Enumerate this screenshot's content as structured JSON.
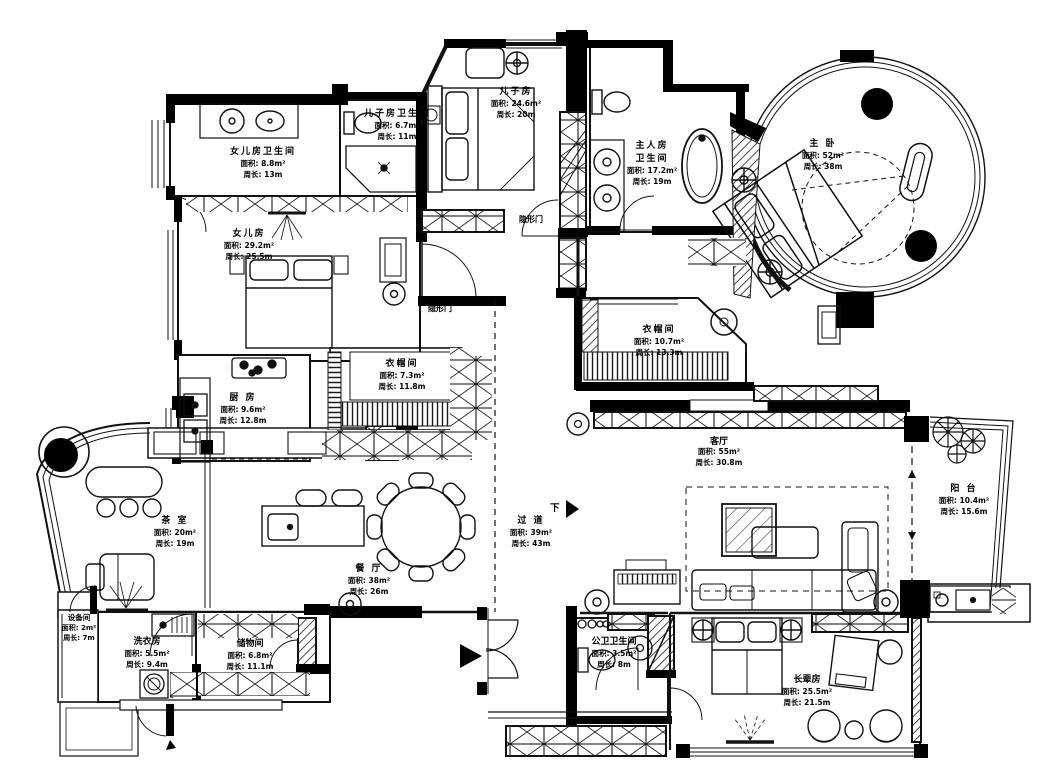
{
  "plan_title": "apartment-floor-plan",
  "colors": {
    "wall": "#000000",
    "line": "#1a1a1a",
    "background": "#ffffff"
  },
  "rooms": {
    "daughter_bath": {
      "name": "女儿房卫生间",
      "area": "面积: 8.8m²",
      "perimeter": "周长: 13m"
    },
    "son_bath": {
      "name": "儿子房卫生间",
      "area": "面积: 6.7m²",
      "perimeter": "周长: 11m"
    },
    "son_room": {
      "name": "儿子房",
      "area": "面积: 24.6m²",
      "perimeter": "周长: 20m"
    },
    "master_bath": {
      "name": "主人房",
      "name2": "卫生间",
      "area": "面积: 17.2m²",
      "perimeter": "周长: 19m"
    },
    "master_bedroom": {
      "name": "主 卧",
      "area": "面积: 52m²",
      "perimeter": "周长: 38m"
    },
    "daughter_room": {
      "name": "女儿房",
      "area": "面积: 29.2m²",
      "perimeter": "周长: 25.5m"
    },
    "closet_a": {
      "name": "衣帽间",
      "area": "面积: 7.3m²",
      "perimeter": "周长: 11.8m"
    },
    "closet_b": {
      "name": "衣帽间",
      "area": "面积: 10.7m²",
      "perimeter": "周长: 13.3m"
    },
    "kitchen": {
      "name": "厨 房",
      "area": "面积: 9.6m²",
      "perimeter": "周长: 12.8m"
    },
    "tea_room": {
      "name": "茶 室",
      "area": "面积: 20m²",
      "perimeter": "周长: 19m"
    },
    "dining": {
      "name": "餐 厅",
      "area": "面积: 38m²",
      "perimeter": "周长: 26m"
    },
    "corridor": {
      "name": "过 道",
      "area": "面积: 39m²",
      "perimeter": "周长: 43m"
    },
    "living": {
      "name": "客厅",
      "area": "面积: 55m²",
      "perimeter": "周长: 30.8m"
    },
    "balcony": {
      "name": "阳 台",
      "area": "面积: 10.4m²",
      "perimeter": "周长: 15.6m"
    },
    "equipment": {
      "name": "设备间",
      "area": "面积: 2m²",
      "perimeter": "周长: 7m"
    },
    "laundry": {
      "name": "洗衣房",
      "area": "面积: 5.5m²",
      "perimeter": "周长: 9.4m"
    },
    "storage": {
      "name": "储物间",
      "area": "面积: 6.8m²",
      "perimeter": "周长: 11.1m"
    },
    "guest_bath": {
      "name": "公卫卫生间",
      "area": "面积: 3.5m²",
      "perimeter": "周长: 8m"
    },
    "elder_room": {
      "name": "长辈房",
      "area": "面积: 25.5m²",
      "perimeter": "周长: 21.5m"
    }
  },
  "annotations": {
    "hidden_door_upper": "隐形门",
    "hidden_door_lower": "隐形门",
    "stair_down": "下"
  }
}
